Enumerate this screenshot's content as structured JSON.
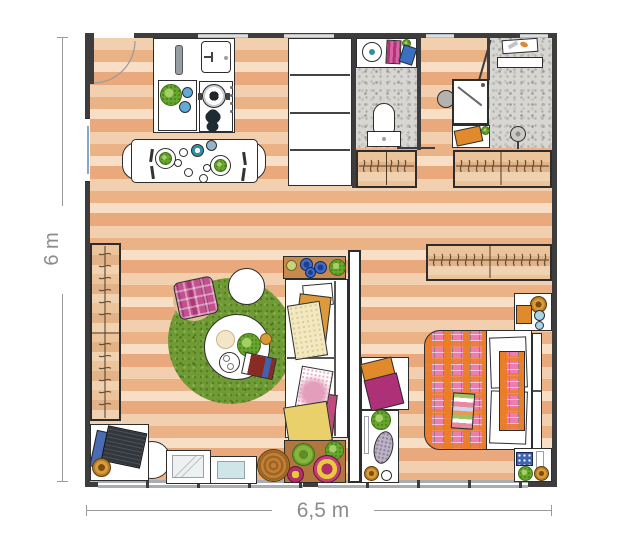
{
  "plan": {
    "type": "apartment-floor-plan",
    "width_label": "6,5 m",
    "height_label": "6 m"
  },
  "palette": {
    "wall": "#3d3d3d",
    "wood_light": "#f7dec4",
    "wood_dark": "#e9a97c",
    "tile_gray": "#d8d6d2",
    "rug_green": "#6f9a35",
    "pink": "#ee7cae",
    "magenta": "#b5347a",
    "orange": "#e08a2b",
    "yellow": "#ead06b",
    "blue": "#3f63ae",
    "teal": "#2f8fa5",
    "gold": "#d89c3a",
    "label_text": "#8c8c8c"
  },
  "rooms": {
    "kitchen_dining": {
      "items": [
        "entry-door",
        "window",
        "tall-cabinet",
        "kitchen-island",
        "cutting-board",
        "sink",
        "hob",
        "pot",
        "dining-table",
        "chairs",
        "tableware"
      ]
    },
    "bathroom": {
      "items": [
        "vanity",
        "washbasin",
        "towels",
        "toilet",
        "sliding-door"
      ]
    },
    "shower_room": {
      "items": [
        "toiletry-shelf",
        "wall-shelf",
        "shower-cabin",
        "side-table",
        "bath-mat",
        "towel",
        "shower-head",
        "door"
      ]
    },
    "hallway": {
      "items": [
        "wardrobe-left",
        "wardrobe-right"
      ]
    },
    "living_room": {
      "items": [
        "wardrobe",
        "round-rug",
        "plaid-pouf",
        "stool",
        "coffee-table",
        "sofa",
        "side-table",
        "floor-cushions",
        "desk",
        "laptop",
        "desk-chair",
        "desk-stool",
        "picture-frames",
        "rattan-pouf"
      ]
    },
    "bedroom": {
      "items": [
        "wardrobe",
        "double-bed",
        "plaid-blanket",
        "pillows",
        "headboard",
        "nightstand-top",
        "nightstand-bottom",
        "bench",
        "towels",
        "console"
      ]
    }
  }
}
